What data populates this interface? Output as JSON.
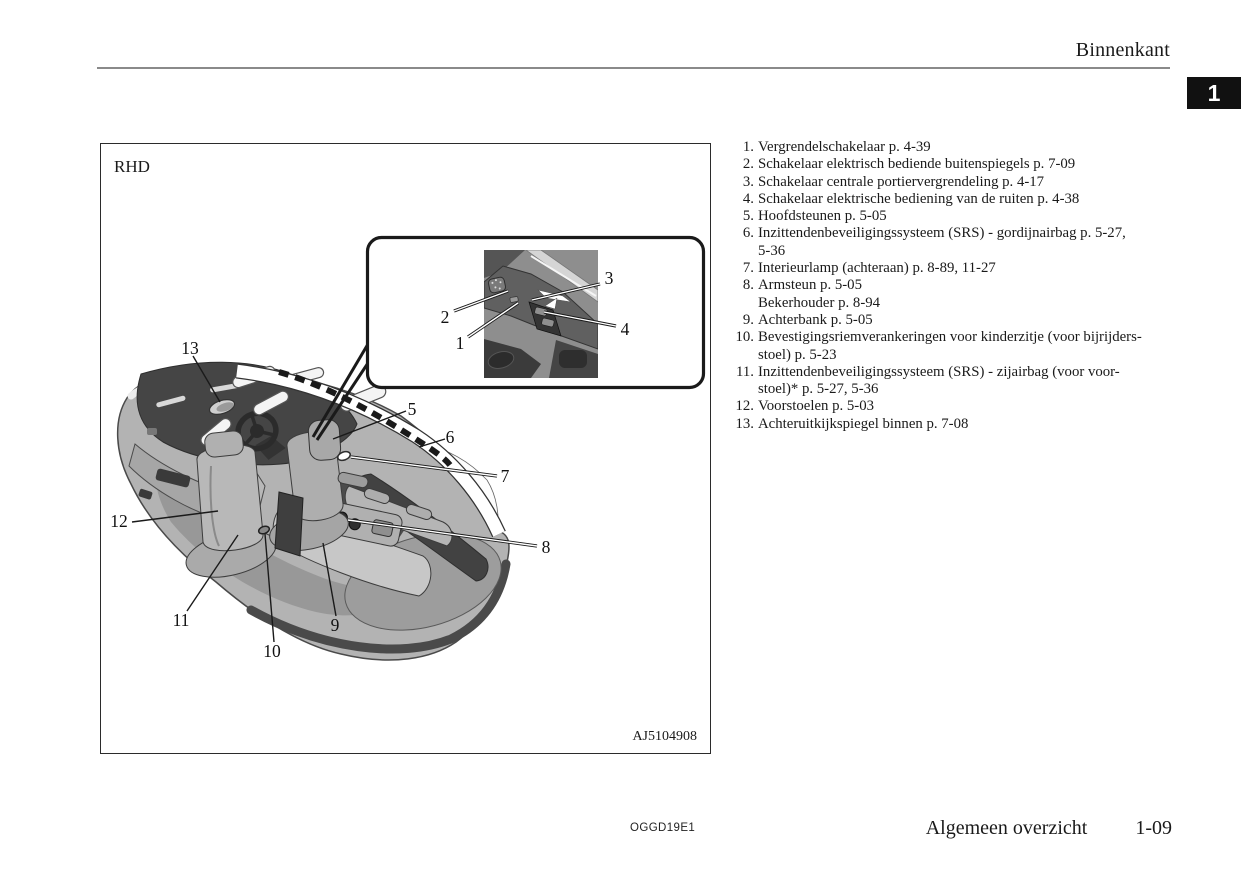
{
  "page": {
    "header": {
      "section_title": "Binnenkant",
      "chapter_tab": "1"
    },
    "footer": {
      "doc_code": "OGGD19E1",
      "chapter_title": "Algemeen overzicht",
      "page_number": "1-09"
    }
  },
  "figure": {
    "drive_label": "RHD",
    "figure_code": "AJ5104908",
    "callouts": {
      "n1": "1",
      "n2": "2",
      "n3": "3",
      "n4": "4",
      "n5": "5",
      "n6": "6",
      "n7": "7",
      "n8": "8",
      "n9": "9",
      "n10": "10",
      "n11": "11",
      "n12": "12",
      "n13": "13"
    }
  },
  "legend": {
    "items": [
      {
        "num": "1.",
        "lines": [
          "Vergrendelschakelaar p. 4-39"
        ]
      },
      {
        "num": "2.",
        "lines": [
          "Schakelaar elektrisch bediende buitenspiegels p. 7-09"
        ]
      },
      {
        "num": "3.",
        "lines": [
          "Schakelaar centrale portiervergrendeling p. 4-17"
        ]
      },
      {
        "num": "4.",
        "lines": [
          "Schakelaar elektrische bediening van de ruiten p. 4-38"
        ]
      },
      {
        "num": "5.",
        "lines": [
          "Hoofdsteunen p. 5-05"
        ]
      },
      {
        "num": "6.",
        "lines": [
          "Inzittendenbeveiligingssysteem (SRS) - gordijnairbag p. 5-27,",
          "5-36"
        ]
      },
      {
        "num": "7.",
        "lines": [
          "Interieurlamp (achteraan) p. 8-89, 11-27"
        ]
      },
      {
        "num": "8.",
        "lines": [
          "Armsteun p. 5-05",
          "Bekerhouder p. 8-94"
        ]
      },
      {
        "num": "9.",
        "lines": [
          "Achterbank p. 5-05"
        ]
      },
      {
        "num": "10.",
        "lines": [
          "Bevestigingsriemverankeringen voor kinderzitje (voor bijrijders-",
          "stoel) p. 5-23"
        ]
      },
      {
        "num": "11.",
        "lines": [
          "Inzittendenbeveiligingssysteem (SRS) - zijairbag (voor voor-",
          "stoel)* p. 5-27, 5-36"
        ]
      },
      {
        "num": "12.",
        "lines": [
          "Voorstoelen p. 5-03"
        ]
      },
      {
        "num": "13.",
        "lines": [
          "Achteruitkijkspiegel binnen p. 7-08"
        ]
      }
    ]
  }
}
